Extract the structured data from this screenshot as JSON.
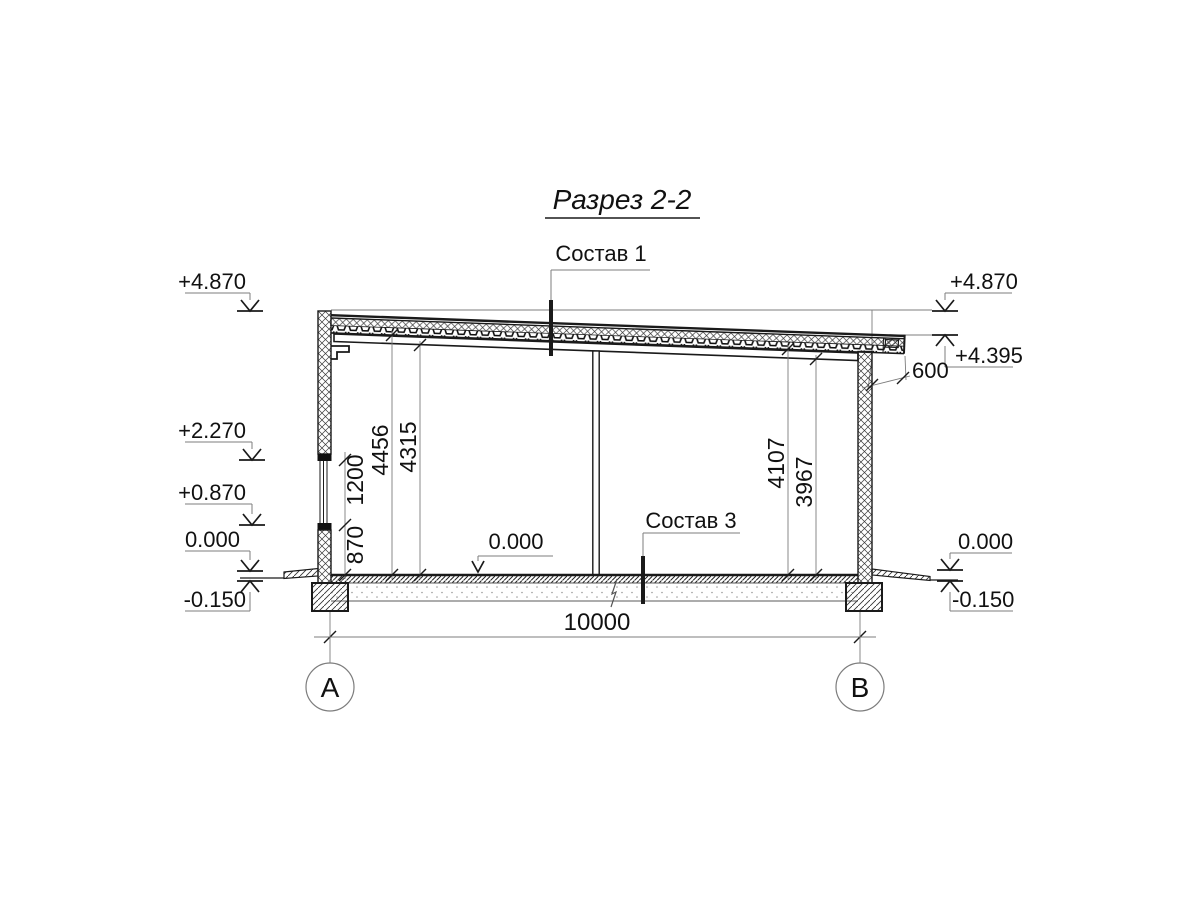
{
  "title": "Разрез 2-2",
  "callouts": {
    "roof": "Состав 1",
    "floor": "Состав 3"
  },
  "elevation_marks": {
    "left": {
      "parapet": "+4.870",
      "window_head": "+2.270",
      "window_sill": "+0.870",
      "floor": "0.000",
      "grade": "-0.150"
    },
    "right": {
      "parapet": "+4.870",
      "roof_low": "+4.395",
      "floor": "0.000",
      "grade": "-0.150"
    },
    "interior_floor": "0.000"
  },
  "dimensions": {
    "overall_width": "10000",
    "roof_overhang": "600",
    "left_wall": {
      "sill_height": "870",
      "window_height": "1200"
    },
    "interior_heights": {
      "left_to_deck": "4456",
      "left_to_beam": "4315",
      "right_to_deck": "4107",
      "right_to_beam": "3967"
    }
  },
  "axes": {
    "left": "А",
    "right": "В"
  },
  "colors": {
    "line": "#1a1a1a",
    "dim_line": "#7d7d7d",
    "background": "#ffffff"
  }
}
